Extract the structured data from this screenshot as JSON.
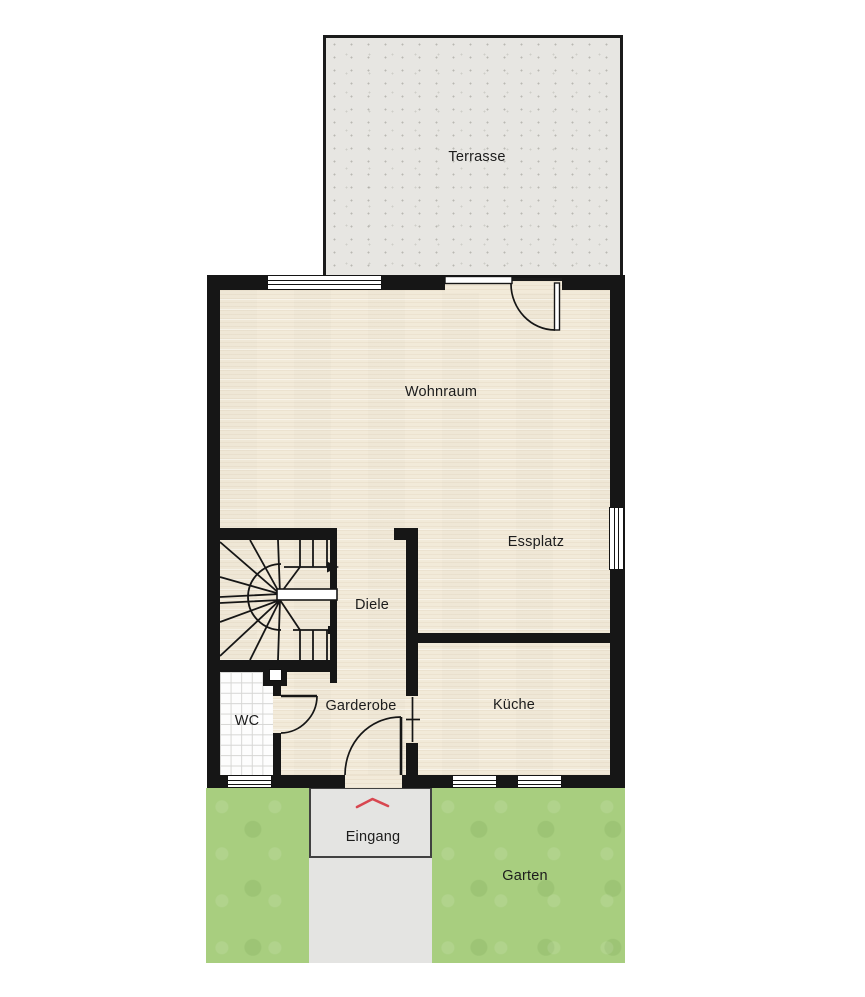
{
  "plan_title": "Erdgeschoss Grundriss",
  "rooms": {
    "terrasse": "Terrasse",
    "wohnraum": "Wohnraum",
    "essplatz": "Essplatz",
    "diele": "Diele",
    "wc": "WC",
    "garderobe": "Garderobe",
    "kueche": "Küche",
    "eingang": "Eingang",
    "garten": "Garten"
  },
  "markers": {
    "entrance_marker": "chevron-up",
    "stair_direction": "arrow-right"
  },
  "colors": {
    "wall": "#161616",
    "wood_floor": "#f2ead9",
    "terrace": "#e7e6e2",
    "garden": "#a8ce7f",
    "entry_path": "#e4e4e2",
    "entry_border": "#414141",
    "entrance_chevron": "#d84750",
    "tile_grid": "#d6d6d4",
    "background": "#ffffff"
  }
}
